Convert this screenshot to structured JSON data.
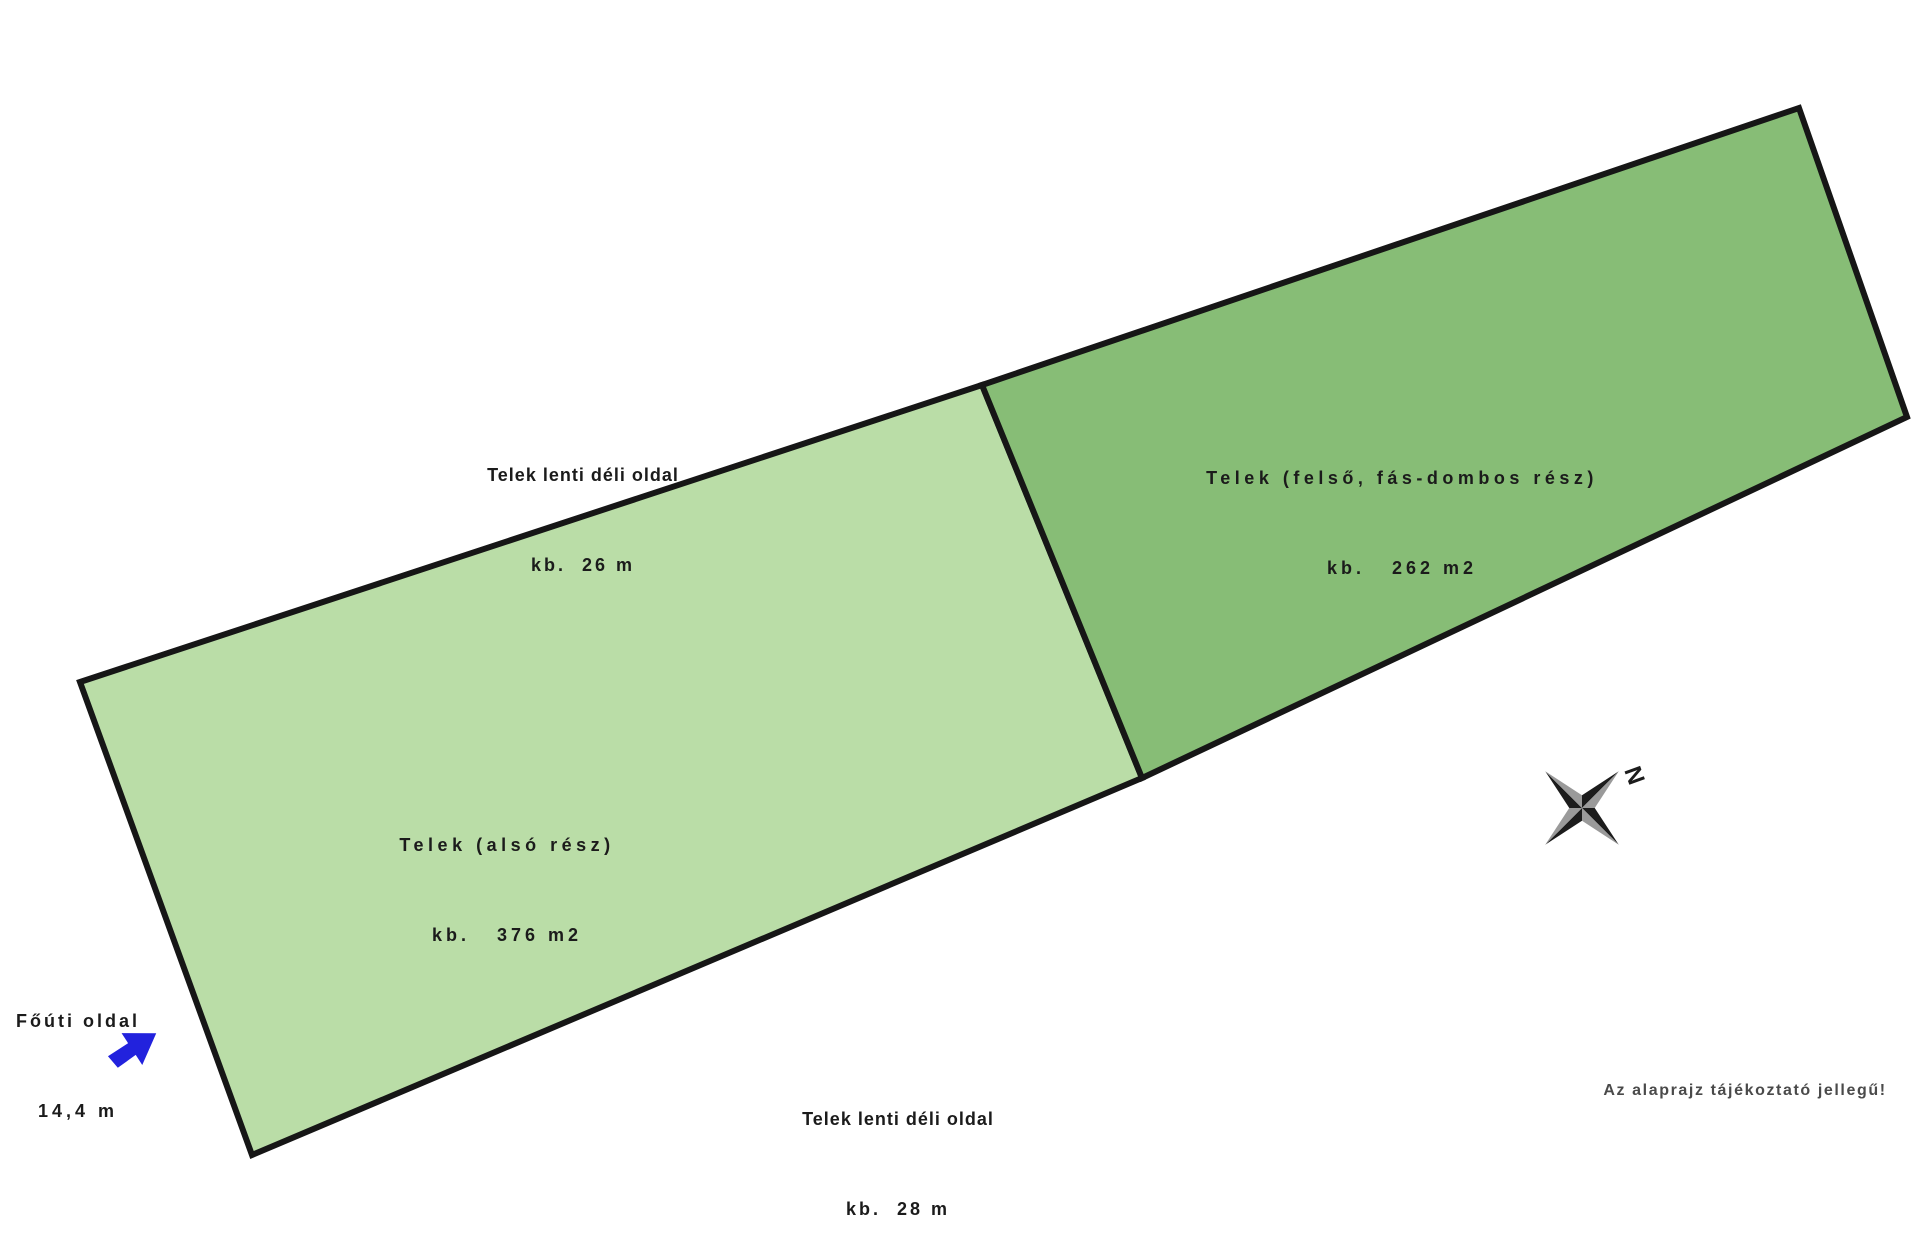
{
  "diagram": {
    "plots": {
      "lower": {
        "name": "Telek (alsó rész)",
        "area": "kb.   376 m2",
        "fill": "#badda7"
      },
      "upper": {
        "name": "Telek (felső, fás-dombos rész)",
        "area": "kb.   262 m2",
        "fill": "#87bd76"
      }
    },
    "measurements": {
      "top_side": {
        "label": "Telek lenti déli oldal",
        "value": "kb.  26 m"
      },
      "bottom_side": {
        "label": "Telek lenti déli oldal",
        "value": "kb.  28 m"
      },
      "road_side": {
        "label": "Főúti oldal",
        "value": "14,4 m"
      }
    },
    "note": "Az alaprajz tájékoztató jellegű!",
    "compass": {
      "north_label": "N"
    },
    "colors": {
      "outline": "#161616",
      "arrow_blue": "#2222dd",
      "compass_dark": "#1c1c1c",
      "compass_gray": "#9a9a9a",
      "text": "#1b1b1b",
      "note_text": "#4a4a4a"
    }
  }
}
